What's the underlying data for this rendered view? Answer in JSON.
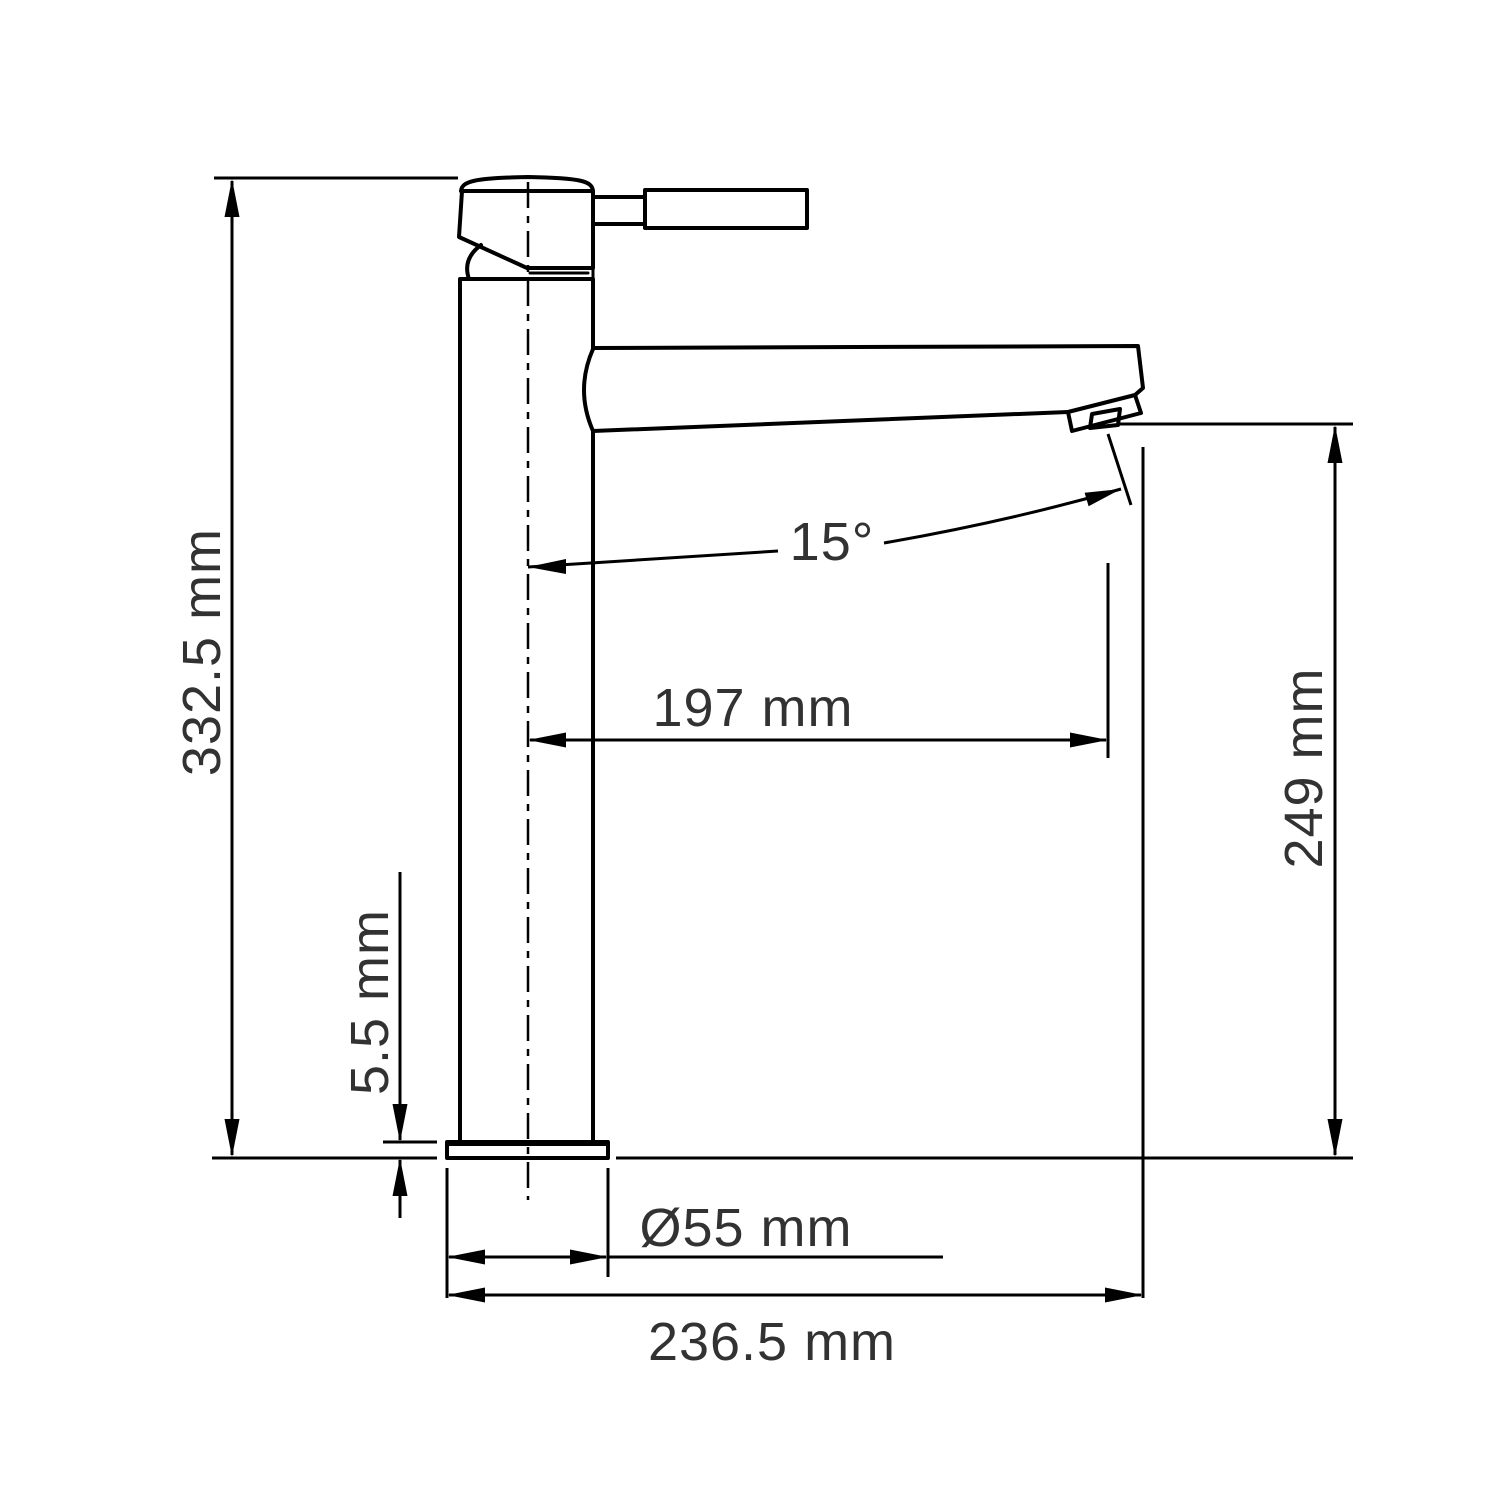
{
  "drawing": {
    "background": "#ffffff",
    "line_color": "#000000",
    "text_color": "#323232",
    "unit": "mm",
    "dimensions": {
      "overall_height": {
        "label": "332.5 mm",
        "value": 332.5
      },
      "spout_height": {
        "label": "249 mm",
        "value": 249
      },
      "spout_reach": {
        "label": "197 mm",
        "value": 197
      },
      "spout_angle": {
        "label": "15°",
        "value": 15
      },
      "base_thickness": {
        "label": "5.5 mm",
        "value": 5.5
      },
      "base_diameter": {
        "label": "Ø55 mm",
        "value": 55
      },
      "overall_depth": {
        "label": "236.5 mm",
        "value": 236.5
      }
    }
  }
}
